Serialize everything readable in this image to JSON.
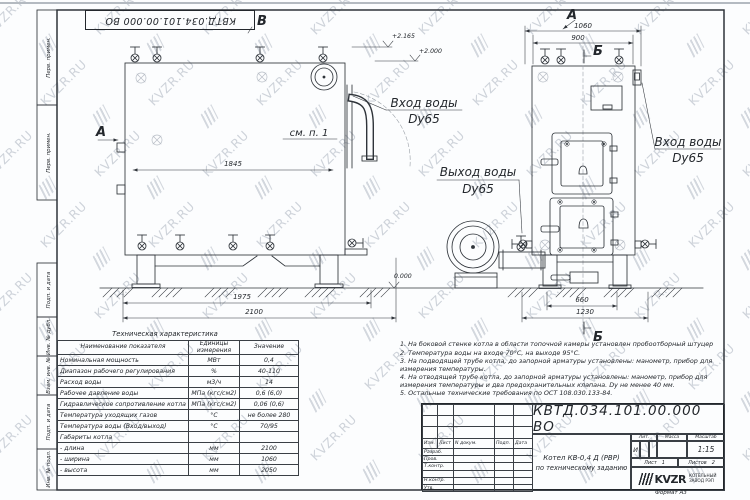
{
  "doc_number": "КВТД.034.101.00.000  ВО",
  "watermark": {
    "text": "KVZR.RU"
  },
  "frame": {
    "strip": [
      "Перв. примен.",
      "Перв. примен.",
      "Подп. и дата",
      "Инв. № дубл.",
      "Взам. инв. №",
      "Подп. и дата",
      "Инв. № подл."
    ],
    "format_note": "Формат    А3"
  },
  "drawing": {
    "view_b": "В",
    "section_a": "А",
    "view_a": "А",
    "section_b_top": "Б",
    "section_b_bottom": "Б",
    "see_note": "см. п. 1",
    "levels": {
      "l1": "+2.165",
      "l2": "+2.000",
      "l0": "0.000"
    },
    "labels": {
      "inlet1_t": "Вход воды",
      "inlet1_d": "Dy65",
      "outlet_t": "Выход воды",
      "outlet_d": "Dy65",
      "inlet2_t": "Вход воды",
      "inlet2_d": "Dy65"
    },
    "dims": {
      "d1845": "1845",
      "d1975": "1975",
      "d2100": "2100",
      "d1060": "1060",
      "d900": "900",
      "d660": "660",
      "d1230": "1230"
    }
  },
  "tech_table": {
    "title": "Техническая характеристика",
    "headers": {
      "name": "Наименование показателя",
      "units": "Единицы\nизмерения",
      "value": "Значение"
    },
    "rows": [
      [
        "Номинальная мощность",
        "МВт",
        "0,4"
      ],
      [
        "Диапазон рабочего регулирования",
        "%",
        "40-110"
      ],
      [
        "Расход воды",
        "м3/ч",
        "14"
      ],
      [
        "Рабочее давление воды",
        "МПа (кгс/см2)",
        "0,6 (6,0)"
      ],
      [
        "Гидравлическое сопротивление котла",
        "МПа (кгс/см2)",
        "0,06 (0,6)"
      ],
      [
        "Температура уходящих газов",
        "°С",
        "не более 280"
      ],
      [
        "Температура воды (Вход/выход)",
        "°С",
        "70/95"
      ],
      [
        "Габариты котла",
        "",
        ""
      ],
      [
        "- длина",
        "мм",
        "2100"
      ],
      [
        "- ширина",
        "мм",
        "1060"
      ],
      [
        "- высота",
        "мм",
        "2050"
      ]
    ]
  },
  "notes": {
    "items": [
      "1.  На боковой стенке котла в области топочной камеры установлен пробоотборный штуцер",
      "2.  Температура воды на входе 70°С, на выходе 95°С.",
      "3.  На подводящей трубе котла, до запорной арматуры установлены: манометр, прибор для измерения температуры.",
      "4.  На отводящей трубе котла, до запорной арматуры установлены: манометр, прибор для измерения температуры и два предохранительных клапана. Dу не менее 40 мм.",
      "5.  Остальные технические требования по ОСТ 108.030.133-84."
    ]
  },
  "title_block": {
    "rev_headers": [
      "Изм.",
      "Лист",
      "N докум.",
      "Подп.",
      "Дата"
    ],
    "roles": [
      "Разраб.",
      "Пров.",
      "Т.контр.",
      "",
      "Н.контр.",
      "Утв."
    ],
    "title_line1": "Котел  КВ-0,4  Д  (РВР)",
    "title_line2": "по техническому заданию",
    "lit_header": "Лит.",
    "mass_header": "Масса",
    "scale_header": "Масштаб",
    "lit_value": "И",
    "scale_value": "1:15",
    "sheet_label": "Лист",
    "sheet_value": "1",
    "sheets_label": "Листов",
    "sheets_value": "2",
    "logo_text": "KVZR",
    "logo_sub1": "КОТЕЛЬНЫЙ",
    "logo_sub2": "ЗАВОД РЭП"
  }
}
